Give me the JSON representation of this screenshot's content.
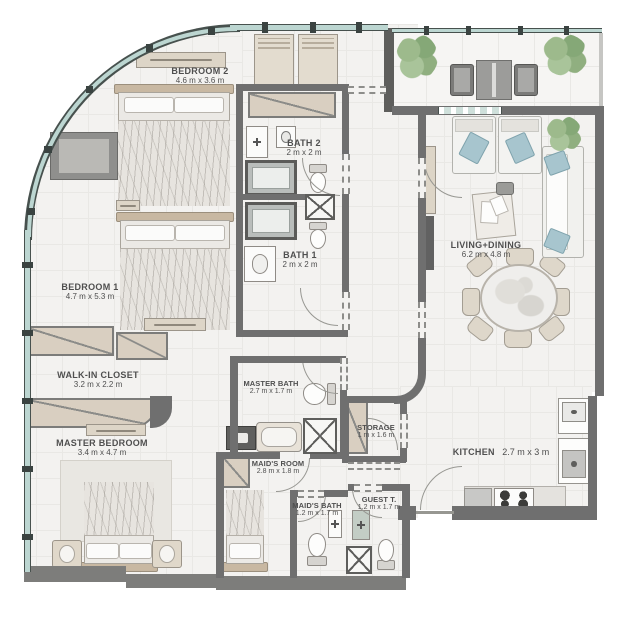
{
  "floorplan": {
    "rooms": {
      "bedroom_2": {
        "name": "BEDROOM 2",
        "dims": "4.6 m x 3.6 m"
      },
      "bath_2": {
        "name": "BATH 2",
        "dims": "2 m x 2 m"
      },
      "bedroom_1": {
        "name": "BEDROOM 1",
        "dims": "4.7 m x 5.3 m"
      },
      "bath_1": {
        "name": "BATH 1",
        "dims": "2 m x 2 m"
      },
      "walk_in_closet": {
        "name": "WALK-IN CLOSET",
        "dims": "3.2 m x 2.2 m"
      },
      "master_bedroom": {
        "name": "MASTER BEDROOM",
        "dims": "3.4 m x 4.7 m"
      },
      "master_bath": {
        "name": "MASTER BATH",
        "dims": "2.7 m x 1.7 m"
      },
      "storage": {
        "name": "STORAGE",
        "dims": "1 m x 1.6 m"
      },
      "maids_room": {
        "name": "MAID'S ROOM",
        "dims": "2.8 m x 1.8 m"
      },
      "maids_bath": {
        "name": "MAID'S BATH",
        "dims": "1.2 m x 1.7 m"
      },
      "guest_toilet": {
        "name": "GUEST T.",
        "dims": "1.2 m x 1.7 m"
      },
      "living_dining": {
        "name": "LIVING+DINING",
        "dims": "6.2 m x 4.8 m"
      },
      "kitchen": {
        "name": "KITCHEN",
        "dims": "2.7 m x 3 m"
      }
    },
    "colors": {
      "wall": "#6f6f6f",
      "glass": "#bcd6d1",
      "glass_frame": "#47514e",
      "floor": "#f3f2f0",
      "wood": "#d9cfc1",
      "wood_dark": "#c8b8a2",
      "accent_blue": "#a7c5ce",
      "plant_green": "#93b184",
      "label_text": "#4f4f4f"
    }
  }
}
